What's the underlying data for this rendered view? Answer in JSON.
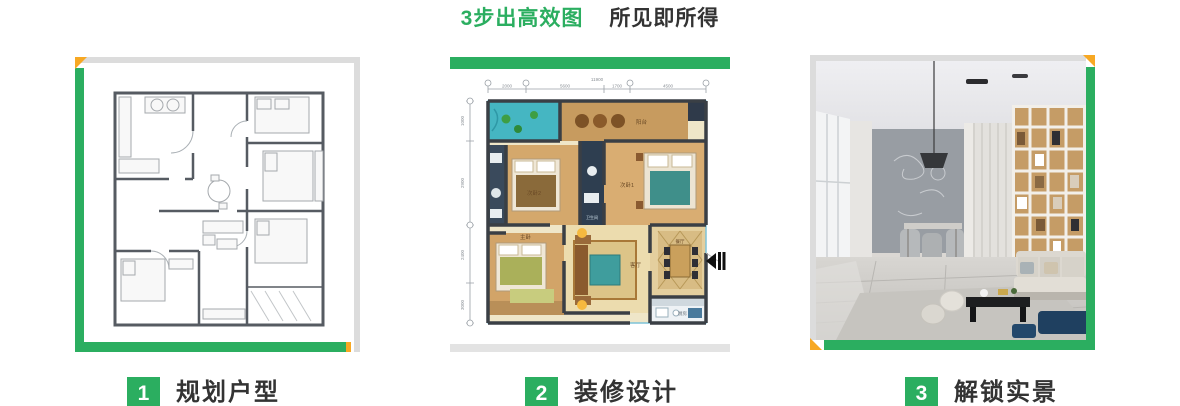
{
  "title": {
    "highlight": "3步出高效图",
    "rest": "所见即所得"
  },
  "colors": {
    "green": "#2bae60",
    "orange": "#f7a823",
    "border_gray": "#dcdcdc",
    "text_dark": "#333333"
  },
  "steps": [
    {
      "number": "1",
      "label": "规划户型"
    },
    {
      "number": "2",
      "label": "装修设计"
    },
    {
      "number": "3",
      "label": "解锁实景"
    }
  ],
  "panels": {
    "color_plan": {
      "dim_total_top": "11900",
      "dims_top": [
        "2000",
        "5600",
        "1700",
        "4500"
      ],
      "dims_left": [
        "1000",
        "2900",
        "2400",
        "3000"
      ],
      "rooms": {
        "balcony": "阳台",
        "bedroom1": "次卧1",
        "bedroom2": "次卧2",
        "bathroom": "卫生间",
        "master_bedroom": "主卧",
        "living_room": "客厅",
        "dining_room": "餐厅",
        "kitchen": "厨房"
      }
    }
  }
}
